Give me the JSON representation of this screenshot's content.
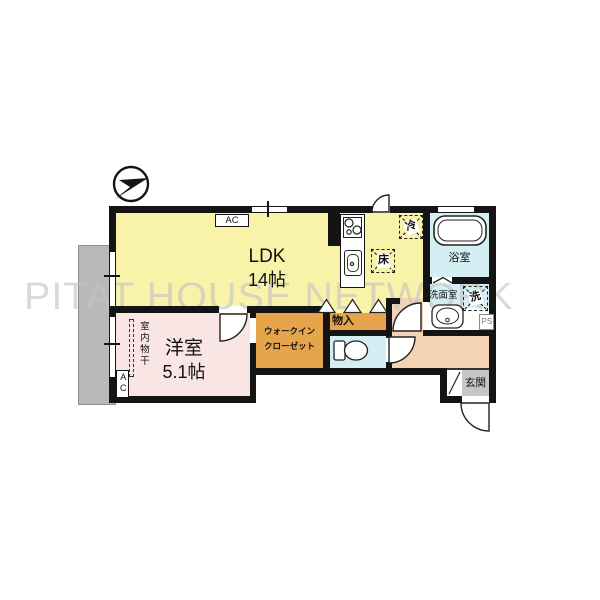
{
  "watermark": "PITAT HOUSE NETWORK",
  "compass": {
    "icon": "north-arrow"
  },
  "rooms": {
    "ldk": {
      "label": "LDK",
      "size": "14帖"
    },
    "bedroom": {
      "label": "洋室",
      "size": "5.1帖"
    },
    "walk_in_closet": {
      "line1": "ウォークイン",
      "line2": "クローゼット"
    },
    "storage": {
      "label": "物入"
    },
    "bath": {
      "label": "浴室"
    },
    "washroom": {
      "label": "洗面室"
    },
    "entrance": {
      "label": "玄関"
    }
  },
  "fixtures": {
    "ac_unit": "AC",
    "ac_bedroom": "AC",
    "refrigerator": "冷",
    "floor_hatch": "床",
    "washer": "洗",
    "pipe_space": "PS",
    "indoor_drying": "室内物干"
  },
  "colors": {
    "ldk": "#f8f3a8",
    "bedroom": "#f8e5e4",
    "closet": "#e6a54d",
    "wet_area": "#d4eef3",
    "hall": "#f3d3b4",
    "entrance_floor": "#c6c6c6",
    "balcony": "#b9b9b9",
    "wall": "#141414",
    "watermark": "#c3c3c3"
  }
}
